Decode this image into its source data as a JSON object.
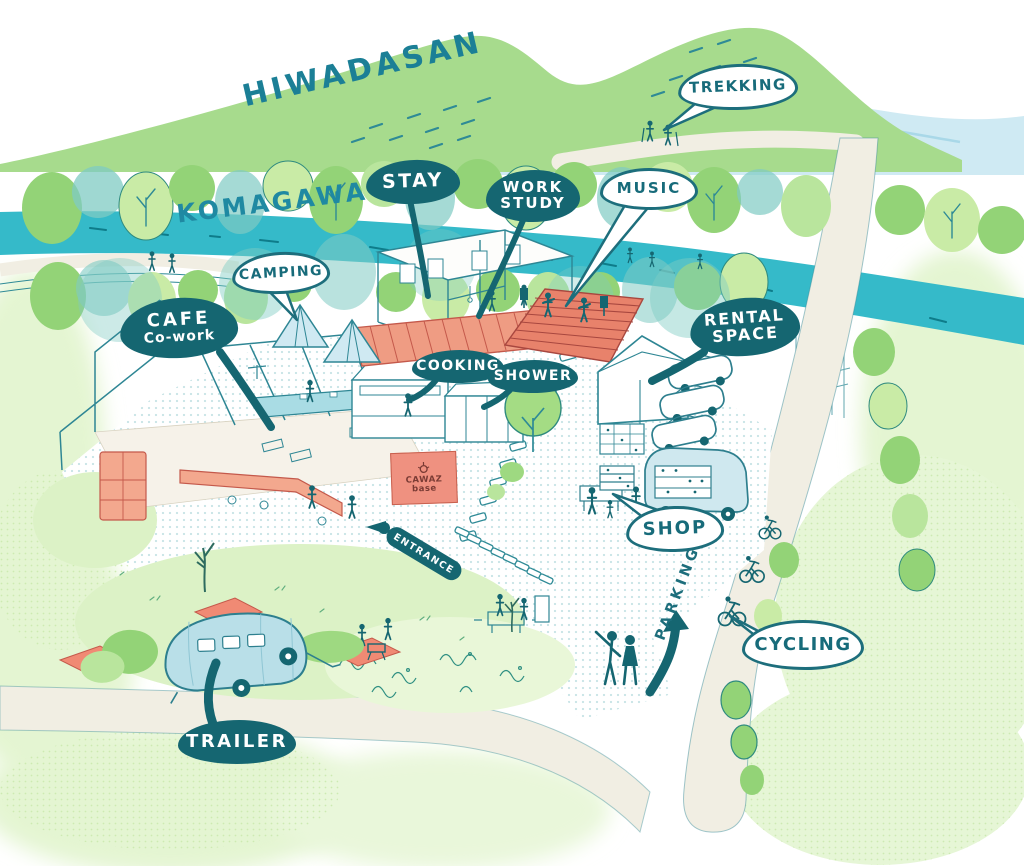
{
  "map": {
    "region_labels": {
      "mountain": "HIWADASAN",
      "river": "KOMAGAWA",
      "parking": "PARKING"
    },
    "bubbles": {
      "trekking": {
        "text": "TREKKING",
        "style": "outline"
      },
      "stay": {
        "text": "STAY",
        "style": "filled"
      },
      "work_study": {
        "line1": "WORK",
        "line2": "STUDY",
        "style": "filled"
      },
      "music": {
        "text": "MUSIC",
        "style": "outline"
      },
      "camping": {
        "text": "CAMPING",
        "style": "outline"
      },
      "cafe_cowork": {
        "line1": "CAFE",
        "line2": "Co-work",
        "style": "filled"
      },
      "cooking": {
        "text": "COOKING",
        "style": "filled"
      },
      "shower": {
        "text": "SHOWER",
        "style": "filled"
      },
      "rental_space": {
        "line1": "RENTAL",
        "line2": "SPACE",
        "style": "filled"
      },
      "shop": {
        "text": "SHOP",
        "style": "outline"
      },
      "cycling": {
        "text": "CYCLING",
        "style": "outline"
      },
      "trailer": {
        "text": "TRAILER",
        "style": "filled"
      },
      "entrance": {
        "text": "ENTRANCE",
        "style": "filled"
      }
    },
    "building_sign": {
      "line1": "CAWAZ",
      "line2": "base"
    },
    "icons": {
      "cawaz_sign": "lightbulb-icon"
    },
    "colors": {
      "label_fill_dark": "#156671",
      "label_outline": "#1d6e7c",
      "text_teal": "#1b7f96",
      "river_cyan": "#35bac9",
      "mountain_green": "#a7db8d",
      "tree_green": "#93d377",
      "tree_teal": "#7fcbc3",
      "road_cream": "#f1eee3",
      "accent_salmon": "#ef9480",
      "vehicle_blue": "#bfe2ec"
    }
  }
}
